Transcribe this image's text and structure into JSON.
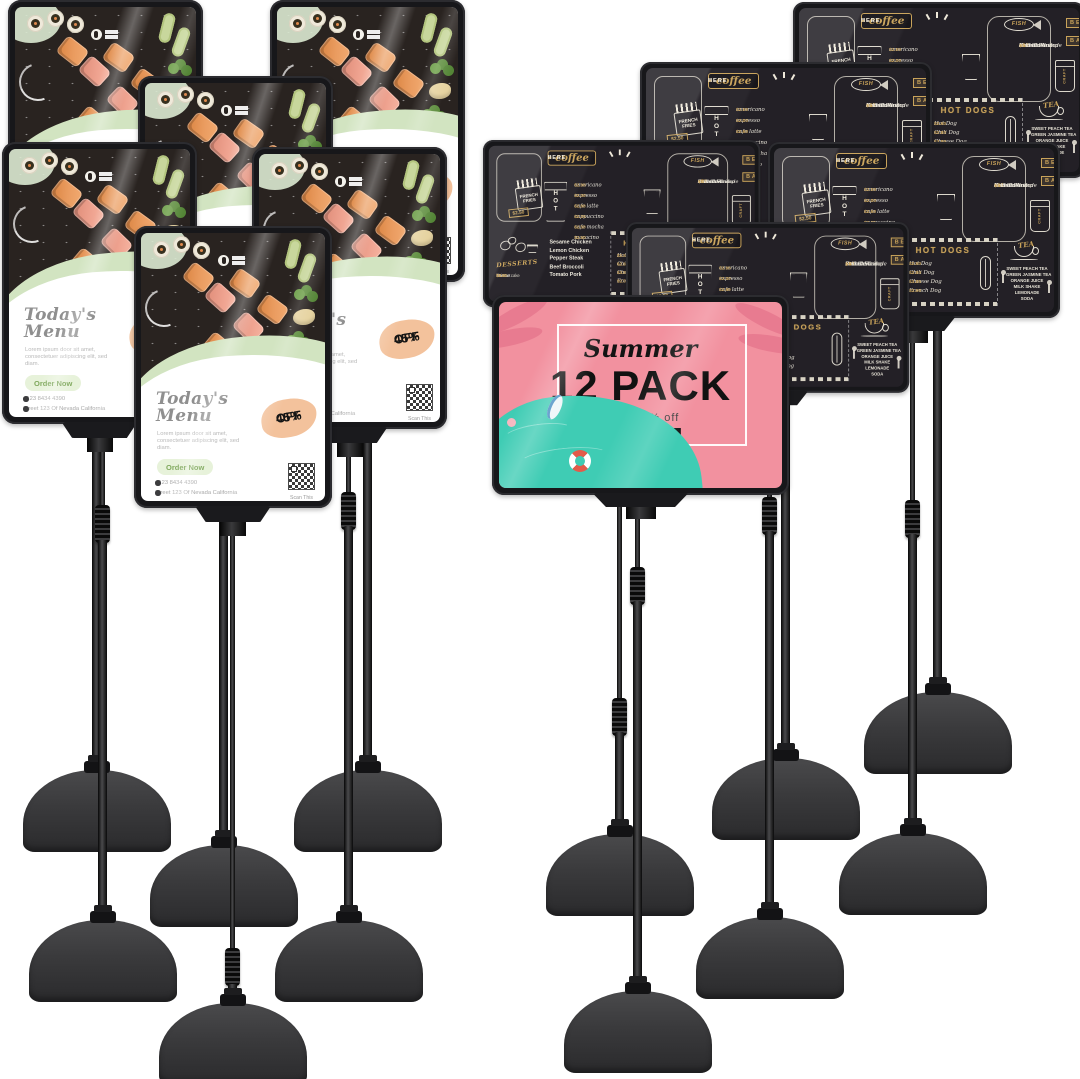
{
  "menu_poster": {
    "title1": "Today's",
    "title2": "Menu",
    "body": "Lorem ipsum door sit amet, consectetuer adipiscing elit, sed diam.",
    "cta": "Order Now",
    "phone": "+123 8434 4390",
    "address": "Street 123 Of Nevada California",
    "discount1": "45%",
    "discount2": "OFF",
    "scan": "Scan This"
  },
  "chalkboard": {
    "best": "BEST",
    "here": "HERE",
    "coffee_label": "coffee",
    "arrow_left": "◄",
    "arrow_right": "►",
    "hot_cup": "HOT",
    "coffee_items": [
      {
        "name": "americano",
        "price": "$2.00"
      },
      {
        "name": "espresso",
        "price": "$2.00"
      },
      {
        "name": "cafe latte",
        "price": "$2.60"
      },
      {
        "name": "cappuccino",
        "price": "$2.25"
      },
      {
        "name": "cafe mocha",
        "price": "$2.50"
      },
      {
        "name": "macacino",
        "price": "$2.60"
      }
    ],
    "fries_label": "FRENCH FRIES",
    "fries_price": "$2.50",
    "fish_label": "FISH",
    "fish_items": [
      {
        "name": "Fish Cake",
        "price": "$12"
      },
      {
        "name": "Grilled Shrimp",
        "price": "$11"
      },
      {
        "name": "Salmon Roulade",
        "price": "$8"
      },
      {
        "name": "Crab Cake",
        "price": "$7"
      },
      {
        "name": "Roasted Cod",
        "price": "$6"
      }
    ],
    "beer1": "BEER",
    "beer2": "BAR",
    "craft": "CRAFT",
    "desserts_label": "DESSERTS",
    "dessert_items": [
      {
        "name": "fruit tart",
        "price": "$7.00"
      },
      {
        "name": "cheese cake",
        "price": "$8.50"
      }
    ],
    "entrees": [
      "Sesame Chicken",
      "Lemon Chicken",
      "Pepper Steak",
      "Beef Broccoli",
      "Tomato Pork"
    ],
    "hotdogs_label": "HOT DOGS",
    "hotdog_items": [
      {
        "name": "Hot Dog",
        "price": "$2.60"
      },
      {
        "name": "Chili Dog",
        "price": "$2.80"
      },
      {
        "name": "Cheese Dog",
        "price": "$3.85"
      },
      {
        "name": "French Dog",
        "price": "$2.50"
      }
    ],
    "tea_label": "TEA",
    "tea_items": [
      "SWEET PEACH TEA",
      "GREEN JASMINE TEA",
      "ORANGE JUICE",
      "MILK SHAKE",
      "LEMONADE",
      "SODA"
    ]
  },
  "summer_sign": {
    "script": "Summer",
    "headline": "12 PACK",
    "sub": "up to 50% off",
    "cta": "SHOP NOW"
  },
  "colors": {
    "frame": "#17171a",
    "chalk_bg": "#232026",
    "chalk_gold": "#c9a35a",
    "summer_pink": "#f2919f",
    "summer_teal": "#3fccb4",
    "poster_green_cta": "#e7f2da",
    "discount_peach": "#f3c29c"
  }
}
